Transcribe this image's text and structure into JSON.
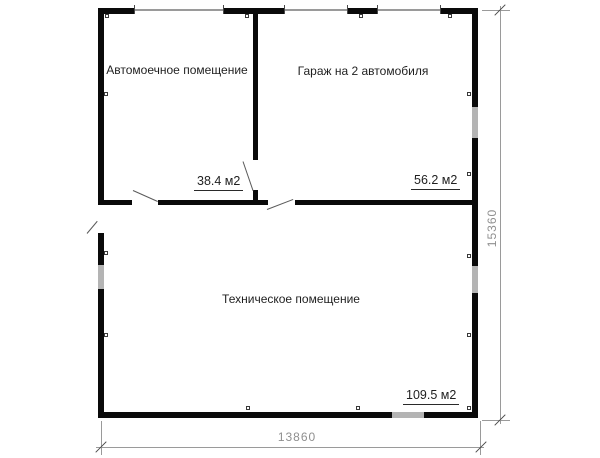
{
  "plan": {
    "rooms": [
      {
        "name": "Автомоечное помещение",
        "area": "38.4 м2"
      },
      {
        "name": "Гараж на 2 автомобиля",
        "area": "56.2 м2"
      },
      {
        "name": "Техническое помещение",
        "area": "109.5 м2"
      }
    ],
    "dimensions": {
      "bottom": "13860",
      "right": "15360"
    }
  },
  "colors": {
    "wall": "#0a0a0a",
    "window": "#b4b4b4",
    "gdoor": "#9a9a9a",
    "dim": "#9a9a9a",
    "dim-text": "#8f8f8f",
    "ink": "#1f1f1f"
  }
}
